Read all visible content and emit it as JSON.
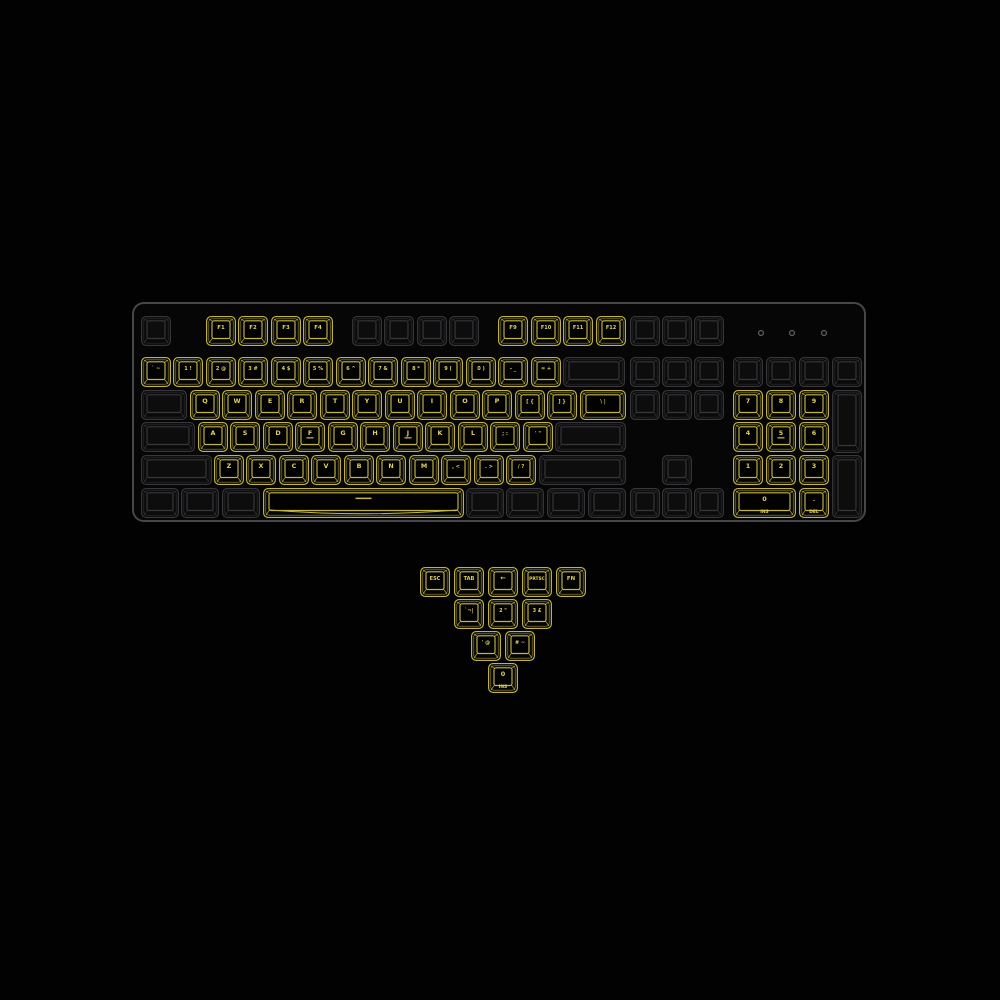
{
  "colors": {
    "background": "#020202",
    "case_fill": "#060606",
    "case_stroke": "#47474a",
    "key_lit": "#c3b544",
    "key_lit_text": "#e0d15c",
    "key_dim": "#38383b",
    "key_dim_fill": "#0a0a0a",
    "led": "#6b6b6e"
  },
  "keyboard": {
    "case": {
      "x": 133,
      "y": 303,
      "w": 732,
      "h": 218,
      "radius": 11
    },
    "leds": [
      {
        "x": 761,
        "y": 333
      },
      {
        "x": 792,
        "y": 333
      },
      {
        "x": 824,
        "y": 333
      }
    ],
    "keys": [
      {
        "id": "esc",
        "x": 141,
        "y": 316,
        "w": 30,
        "h": 30,
        "lit": false,
        "label": ""
      },
      {
        "id": "f1",
        "x": 206,
        "y": 316,
        "w": 30,
        "h": 30,
        "lit": true,
        "label": "F1"
      },
      {
        "id": "f2",
        "x": 238,
        "y": 316,
        "w": 30,
        "h": 30,
        "lit": true,
        "label": "F2"
      },
      {
        "id": "f3",
        "x": 271,
        "y": 316,
        "w": 30,
        "h": 30,
        "lit": true,
        "label": "F3"
      },
      {
        "id": "f4",
        "x": 303,
        "y": 316,
        "w": 30,
        "h": 30,
        "lit": true,
        "label": "F4"
      },
      {
        "id": "f5",
        "x": 352,
        "y": 316,
        "w": 30,
        "h": 30,
        "lit": false,
        "label": ""
      },
      {
        "id": "f6",
        "x": 384,
        "y": 316,
        "w": 30,
        "h": 30,
        "lit": false,
        "label": ""
      },
      {
        "id": "f7",
        "x": 417,
        "y": 316,
        "w": 30,
        "h": 30,
        "lit": false,
        "label": ""
      },
      {
        "id": "f8",
        "x": 449,
        "y": 316,
        "w": 30,
        "h": 30,
        "lit": false,
        "label": ""
      },
      {
        "id": "f9",
        "x": 498,
        "y": 316,
        "w": 30,
        "h": 30,
        "lit": true,
        "label": "F9"
      },
      {
        "id": "f10",
        "x": 531,
        "y": 316,
        "w": 30,
        "h": 30,
        "lit": true,
        "label": "F10"
      },
      {
        "id": "f11",
        "x": 563,
        "y": 316,
        "w": 30,
        "h": 30,
        "lit": true,
        "label": "F11"
      },
      {
        "id": "f12",
        "x": 596,
        "y": 316,
        "w": 30,
        "h": 30,
        "lit": true,
        "label": "F12"
      },
      {
        "id": "prtsc",
        "x": 630,
        "y": 316,
        "w": 30,
        "h": 30,
        "lit": false,
        "label": ""
      },
      {
        "id": "scrlk",
        "x": 662,
        "y": 316,
        "w": 30,
        "h": 30,
        "lit": false,
        "label": ""
      },
      {
        "id": "pause",
        "x": 694,
        "y": 316,
        "w": 30,
        "h": 30,
        "lit": false,
        "label": ""
      },
      {
        "id": "grave",
        "x": 141,
        "y": 357,
        "w": 30,
        "h": 30,
        "lit": true,
        "label": "` ~"
      },
      {
        "id": "1",
        "x": 173,
        "y": 357,
        "w": 30,
        "h": 30,
        "lit": true,
        "label": "1 !"
      },
      {
        "id": "2",
        "x": 206,
        "y": 357,
        "w": 30,
        "h": 30,
        "lit": true,
        "label": "2 @"
      },
      {
        "id": "3",
        "x": 238,
        "y": 357,
        "w": 30,
        "h": 30,
        "lit": true,
        "label": "3 #"
      },
      {
        "id": "4",
        "x": 271,
        "y": 357,
        "w": 30,
        "h": 30,
        "lit": true,
        "label": "4 $"
      },
      {
        "id": "5",
        "x": 303,
        "y": 357,
        "w": 30,
        "h": 30,
        "lit": true,
        "label": "5 %"
      },
      {
        "id": "6",
        "x": 336,
        "y": 357,
        "w": 30,
        "h": 30,
        "lit": true,
        "label": "6 ^"
      },
      {
        "id": "7",
        "x": 368,
        "y": 357,
        "w": 30,
        "h": 30,
        "lit": true,
        "label": "7 &"
      },
      {
        "id": "8",
        "x": 401,
        "y": 357,
        "w": 30,
        "h": 30,
        "lit": true,
        "label": "8 *"
      },
      {
        "id": "9",
        "x": 433,
        "y": 357,
        "w": 30,
        "h": 30,
        "lit": true,
        "label": "9 ("
      },
      {
        "id": "0",
        "x": 466,
        "y": 357,
        "w": 30,
        "h": 30,
        "lit": true,
        "label": "0 )"
      },
      {
        "id": "minus",
        "x": 498,
        "y": 357,
        "w": 30,
        "h": 30,
        "lit": true,
        "label": "- _"
      },
      {
        "id": "equals",
        "x": 531,
        "y": 357,
        "w": 30,
        "h": 30,
        "lit": true,
        "label": "= +"
      },
      {
        "id": "backspace",
        "x": 563,
        "y": 357,
        "w": 62,
        "h": 30,
        "lit": false,
        "label": ""
      },
      {
        "id": "tab",
        "x": 141,
        "y": 390,
        "w": 46,
        "h": 30,
        "lit": false,
        "label": ""
      },
      {
        "id": "q",
        "x": 190,
        "y": 390,
        "w": 30,
        "h": 30,
        "lit": true,
        "label": "Q"
      },
      {
        "id": "w",
        "x": 222,
        "y": 390,
        "w": 30,
        "h": 30,
        "lit": true,
        "label": "W"
      },
      {
        "id": "e",
        "x": 255,
        "y": 390,
        "w": 30,
        "h": 30,
        "lit": true,
        "label": "E"
      },
      {
        "id": "r",
        "x": 287,
        "y": 390,
        "w": 30,
        "h": 30,
        "lit": true,
        "label": "R"
      },
      {
        "id": "t",
        "x": 320,
        "y": 390,
        "w": 30,
        "h": 30,
        "lit": true,
        "label": "T"
      },
      {
        "id": "y",
        "x": 352,
        "y": 390,
        "w": 30,
        "h": 30,
        "lit": true,
        "label": "Y"
      },
      {
        "id": "u",
        "x": 385,
        "y": 390,
        "w": 30,
        "h": 30,
        "lit": true,
        "label": "U"
      },
      {
        "id": "i",
        "x": 417,
        "y": 390,
        "w": 30,
        "h": 30,
        "lit": true,
        "label": "I"
      },
      {
        "id": "o",
        "x": 450,
        "y": 390,
        "w": 30,
        "h": 30,
        "lit": true,
        "label": "O"
      },
      {
        "id": "p",
        "x": 482,
        "y": 390,
        "w": 30,
        "h": 30,
        "lit": true,
        "label": "P"
      },
      {
        "id": "lbracket",
        "x": 515,
        "y": 390,
        "w": 30,
        "h": 30,
        "lit": true,
        "label": "[ {"
      },
      {
        "id": "rbracket",
        "x": 547,
        "y": 390,
        "w": 30,
        "h": 30,
        "lit": true,
        "label": "] }"
      },
      {
        "id": "backslash",
        "x": 580,
        "y": 390,
        "w": 46,
        "h": 30,
        "lit": true,
        "label": "\\ |"
      },
      {
        "id": "caps",
        "x": 141,
        "y": 422,
        "w": 54,
        "h": 30,
        "lit": false,
        "label": ""
      },
      {
        "id": "a",
        "x": 198,
        "y": 422,
        "w": 30,
        "h": 30,
        "lit": true,
        "label": "A"
      },
      {
        "id": "s",
        "x": 230,
        "y": 422,
        "w": 30,
        "h": 30,
        "lit": true,
        "label": "S"
      },
      {
        "id": "d",
        "x": 263,
        "y": 422,
        "w": 30,
        "h": 30,
        "lit": true,
        "label": "D"
      },
      {
        "id": "f",
        "x": 295,
        "y": 422,
        "w": 30,
        "h": 30,
        "lit": true,
        "label": "F",
        "homing": true
      },
      {
        "id": "g",
        "x": 328,
        "y": 422,
        "w": 30,
        "h": 30,
        "lit": true,
        "label": "G"
      },
      {
        "id": "h",
        "x": 360,
        "y": 422,
        "w": 30,
        "h": 30,
        "lit": true,
        "label": "H"
      },
      {
        "id": "j",
        "x": 393,
        "y": 422,
        "w": 30,
        "h": 30,
        "lit": true,
        "label": "J",
        "homing": true
      },
      {
        "id": "k",
        "x": 425,
        "y": 422,
        "w": 30,
        "h": 30,
        "lit": true,
        "label": "K"
      },
      {
        "id": "l",
        "x": 458,
        "y": 422,
        "w": 30,
        "h": 30,
        "lit": true,
        "label": "L"
      },
      {
        "id": "semicolon",
        "x": 490,
        "y": 422,
        "w": 30,
        "h": 30,
        "lit": true,
        "label": "; :"
      },
      {
        "id": "quote",
        "x": 523,
        "y": 422,
        "w": 30,
        "h": 30,
        "lit": true,
        "label": "' \""
      },
      {
        "id": "enter",
        "x": 555,
        "y": 422,
        "w": 71,
        "h": 30,
        "lit": false,
        "label": ""
      },
      {
        "id": "lshift",
        "x": 141,
        "y": 455,
        "w": 71,
        "h": 30,
        "lit": false,
        "label": ""
      },
      {
        "id": "z",
        "x": 214,
        "y": 455,
        "w": 30,
        "h": 30,
        "lit": true,
        "label": "Z"
      },
      {
        "id": "x",
        "x": 246,
        "y": 455,
        "w": 30,
        "h": 30,
        "lit": true,
        "label": "X"
      },
      {
        "id": "c",
        "x": 279,
        "y": 455,
        "w": 30,
        "h": 30,
        "lit": true,
        "label": "C"
      },
      {
        "id": "v",
        "x": 311,
        "y": 455,
        "w": 30,
        "h": 30,
        "lit": true,
        "label": "V"
      },
      {
        "id": "b",
        "x": 344,
        "y": 455,
        "w": 30,
        "h": 30,
        "lit": true,
        "label": "B"
      },
      {
        "id": "n",
        "x": 376,
        "y": 455,
        "w": 30,
        "h": 30,
        "lit": true,
        "label": "N"
      },
      {
        "id": "m",
        "x": 409,
        "y": 455,
        "w": 30,
        "h": 30,
        "lit": true,
        "label": "M"
      },
      {
        "id": "comma",
        "x": 441,
        "y": 455,
        "w": 30,
        "h": 30,
        "lit": true,
        "label": ", <"
      },
      {
        "id": "period",
        "x": 474,
        "y": 455,
        "w": 30,
        "h": 30,
        "lit": true,
        "label": ". >"
      },
      {
        "id": "slash",
        "x": 506,
        "y": 455,
        "w": 30,
        "h": 30,
        "lit": true,
        "label": "/ ?"
      },
      {
        "id": "rshift",
        "x": 539,
        "y": 455,
        "w": 87,
        "h": 30,
        "lit": false,
        "label": ""
      },
      {
        "id": "lctrl",
        "x": 141,
        "y": 488,
        "w": 38,
        "h": 30,
        "lit": false,
        "label": ""
      },
      {
        "id": "lwin",
        "x": 181,
        "y": 488,
        "w": 38,
        "h": 30,
        "lit": false,
        "label": ""
      },
      {
        "id": "lalt",
        "x": 222,
        "y": 488,
        "w": 38,
        "h": 30,
        "lit": false,
        "label": ""
      },
      {
        "id": "space",
        "x": 263,
        "y": 488,
        "w": 201,
        "h": 30,
        "lit": true,
        "label": "",
        "dash": true,
        "curve": true
      },
      {
        "id": "ralt",
        "x": 466,
        "y": 488,
        "w": 38,
        "h": 30,
        "lit": false,
        "label": ""
      },
      {
        "id": "rfn",
        "x": 506,
        "y": 488,
        "w": 38,
        "h": 30,
        "lit": false,
        "label": ""
      },
      {
        "id": "menu",
        "x": 547,
        "y": 488,
        "w": 38,
        "h": 30,
        "lit": false,
        "label": ""
      },
      {
        "id": "rctrl",
        "x": 588,
        "y": 488,
        "w": 38,
        "h": 30,
        "lit": false,
        "label": ""
      },
      {
        "id": "insert",
        "x": 630,
        "y": 357,
        "w": 30,
        "h": 30,
        "lit": false,
        "label": ""
      },
      {
        "id": "home",
        "x": 662,
        "y": 357,
        "w": 30,
        "h": 30,
        "lit": false,
        "label": ""
      },
      {
        "id": "pgup",
        "x": 694,
        "y": 357,
        "w": 30,
        "h": 30,
        "lit": false,
        "label": ""
      },
      {
        "id": "delete",
        "x": 630,
        "y": 390,
        "w": 30,
        "h": 30,
        "lit": false,
        "label": ""
      },
      {
        "id": "end",
        "x": 662,
        "y": 390,
        "w": 30,
        "h": 30,
        "lit": false,
        "label": ""
      },
      {
        "id": "pgdn",
        "x": 694,
        "y": 390,
        "w": 30,
        "h": 30,
        "lit": false,
        "label": ""
      },
      {
        "id": "up",
        "x": 662,
        "y": 455,
        "w": 30,
        "h": 30,
        "lit": false,
        "label": ""
      },
      {
        "id": "left",
        "x": 630,
        "y": 488,
        "w": 30,
        "h": 30,
        "lit": false,
        "label": ""
      },
      {
        "id": "down",
        "x": 662,
        "y": 488,
        "w": 30,
        "h": 30,
        "lit": false,
        "label": ""
      },
      {
        "id": "right",
        "x": 694,
        "y": 488,
        "w": 30,
        "h": 30,
        "lit": false,
        "label": ""
      },
      {
        "id": "numlock",
        "x": 733,
        "y": 357,
        "w": 30,
        "h": 30,
        "lit": false,
        "label": ""
      },
      {
        "id": "np-div",
        "x": 766,
        "y": 357,
        "w": 30,
        "h": 30,
        "lit": false,
        "label": ""
      },
      {
        "id": "np-mul",
        "x": 799,
        "y": 357,
        "w": 30,
        "h": 30,
        "lit": false,
        "label": ""
      },
      {
        "id": "np-minus",
        "x": 832,
        "y": 357,
        "w": 30,
        "h": 30,
        "lit": false,
        "label": ""
      },
      {
        "id": "np7",
        "x": 733,
        "y": 390,
        "w": 30,
        "h": 30,
        "lit": true,
        "label": "7"
      },
      {
        "id": "np8",
        "x": 766,
        "y": 390,
        "w": 30,
        "h": 30,
        "lit": true,
        "label": "8"
      },
      {
        "id": "np9",
        "x": 799,
        "y": 390,
        "w": 30,
        "h": 30,
        "lit": true,
        "label": "9"
      },
      {
        "id": "np-plus",
        "x": 832,
        "y": 390,
        "w": 30,
        "h": 63,
        "lit": false,
        "label": ""
      },
      {
        "id": "np4",
        "x": 733,
        "y": 422,
        "w": 30,
        "h": 30,
        "lit": true,
        "label": "4"
      },
      {
        "id": "np5",
        "x": 766,
        "y": 422,
        "w": 30,
        "h": 30,
        "lit": true,
        "label": "5",
        "homing": true
      },
      {
        "id": "np6",
        "x": 799,
        "y": 422,
        "w": 30,
        "h": 30,
        "lit": true,
        "label": "6"
      },
      {
        "id": "np1",
        "x": 733,
        "y": 455,
        "w": 30,
        "h": 30,
        "lit": true,
        "label": "1"
      },
      {
        "id": "np2",
        "x": 766,
        "y": 455,
        "w": 30,
        "h": 30,
        "lit": true,
        "label": "2"
      },
      {
        "id": "np3",
        "x": 799,
        "y": 455,
        "w": 30,
        "h": 30,
        "lit": true,
        "label": "3"
      },
      {
        "id": "np-enter",
        "x": 832,
        "y": 455,
        "w": 30,
        "h": 63,
        "lit": false,
        "label": ""
      },
      {
        "id": "np0",
        "x": 733,
        "y": 488,
        "w": 63,
        "h": 30,
        "lit": true,
        "label": "0",
        "sub": "INS"
      },
      {
        "id": "np-dot",
        "x": 799,
        "y": 488,
        "w": 30,
        "h": 30,
        "lit": true,
        "label": ".",
        "sub": "DEL"
      }
    ]
  },
  "extra_keycaps": {
    "keys": [
      {
        "id": "x-esc",
        "x": 420,
        "y": 567,
        "w": 30,
        "h": 30,
        "lit": true,
        "label": "ESC"
      },
      {
        "id": "x-tab",
        "x": 454,
        "y": 567,
        "w": 30,
        "h": 30,
        "lit": true,
        "label": "TAB"
      },
      {
        "id": "x-backspace",
        "x": 488,
        "y": 567,
        "w": 30,
        "h": 30,
        "lit": true,
        "label": "←"
      },
      {
        "id": "x-prtsc",
        "x": 522,
        "y": 567,
        "w": 30,
        "h": 30,
        "lit": true,
        "label": "PRTSC"
      },
      {
        "id": "x-fn",
        "x": 556,
        "y": 567,
        "w": 30,
        "h": 30,
        "lit": true,
        "label": "FN"
      },
      {
        "id": "x-grave-iso",
        "x": 454,
        "y": 599,
        "w": 30,
        "h": 30,
        "lit": true,
        "label": "`¬|"
      },
      {
        "id": "x-2-iso",
        "x": 488,
        "y": 599,
        "w": 30,
        "h": 30,
        "lit": true,
        "label": "2 \""
      },
      {
        "id": "x-3-iso",
        "x": 522,
        "y": 599,
        "w": 30,
        "h": 30,
        "lit": true,
        "label": "3 £"
      },
      {
        "id": "x-quote-iso",
        "x": 471,
        "y": 631,
        "w": 30,
        "h": 30,
        "lit": true,
        "label": "' @"
      },
      {
        "id": "x-hash-iso",
        "x": 505,
        "y": 631,
        "w": 30,
        "h": 30,
        "lit": true,
        "label": "# ~"
      },
      {
        "id": "x-0-ins",
        "x": 488,
        "y": 663,
        "w": 30,
        "h": 30,
        "lit": true,
        "label": "0",
        "sub": "INS"
      }
    ]
  }
}
